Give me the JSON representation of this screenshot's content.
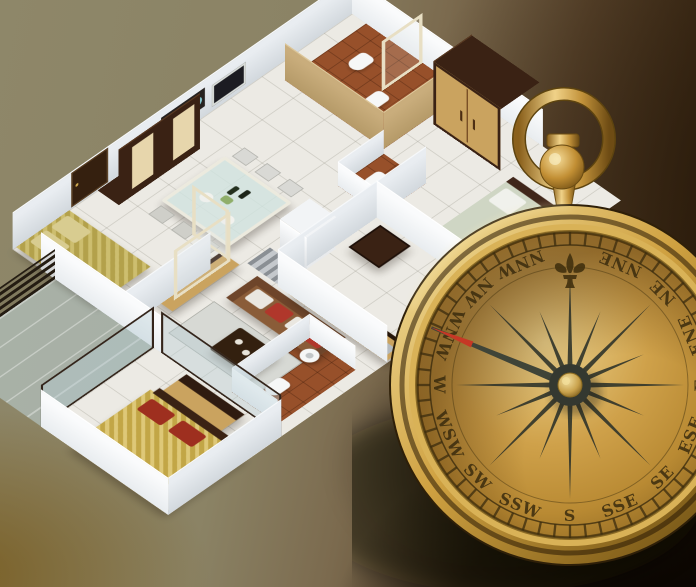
{
  "compass": {
    "cardinal_points": [
      {
        "label": "NNE",
        "angle": 22.5
      },
      {
        "label": "NE",
        "angle": 45
      },
      {
        "label": "ENE",
        "angle": 67.5
      },
      {
        "label": "E",
        "angle": 90
      },
      {
        "label": "ESE",
        "angle": 112.5
      },
      {
        "label": "SE",
        "angle": 135
      },
      {
        "label": "SSE",
        "angle": 157.5
      },
      {
        "label": "S",
        "angle": 180
      },
      {
        "label": "SSW",
        "angle": 202.5
      },
      {
        "label": "SW",
        "angle": 225
      },
      {
        "label": "WSW",
        "angle": 247.5
      },
      {
        "label": "W",
        "angle": 270
      },
      {
        "label": "WNW",
        "angle": 292.5
      },
      {
        "label": "NW",
        "angle": 315
      },
      {
        "label": "NNW",
        "angle": 337.5
      }
    ],
    "north_marker_icon": "fleur-de-lis-icon",
    "needle_direction_deg": 292.5,
    "tick_count": 60,
    "colors": {
      "face": "#c79a3f",
      "bezel_light": "#f2dd9b",
      "bezel_dark": "#7a5a18",
      "label": "#3b2c0e",
      "needle": "#3f4438",
      "needle_tip": "#c63825",
      "hub_knob": "#d8b45c"
    }
  },
  "floor_plan": {
    "rooms": [
      "bedroom-top-left",
      "bathroom-top",
      "wardrobe-cabinet",
      "bedroom-right",
      "kitchen",
      "dining-area",
      "living-room",
      "bathroom-middle",
      "bedroom-bottom",
      "balcony"
    ],
    "colors": {
      "wall": "#f4f6f8",
      "floor_tile": "#eceae4",
      "bathroom_floor": "#97502a",
      "wood_light": "#caa35f",
      "wood_dark": "#3a2214",
      "sofa": "#8a5c38",
      "cushion_red": "#b0372b",
      "bed_olive": "#b3a14b",
      "bed_gold": "#c2a646",
      "glass": "#bcd3d8"
    }
  },
  "background": {
    "top_left": "#8e8769",
    "right": "#4c3a26",
    "bottom_right": "#120b06",
    "bottom_left_gold": "#6b5416"
  }
}
